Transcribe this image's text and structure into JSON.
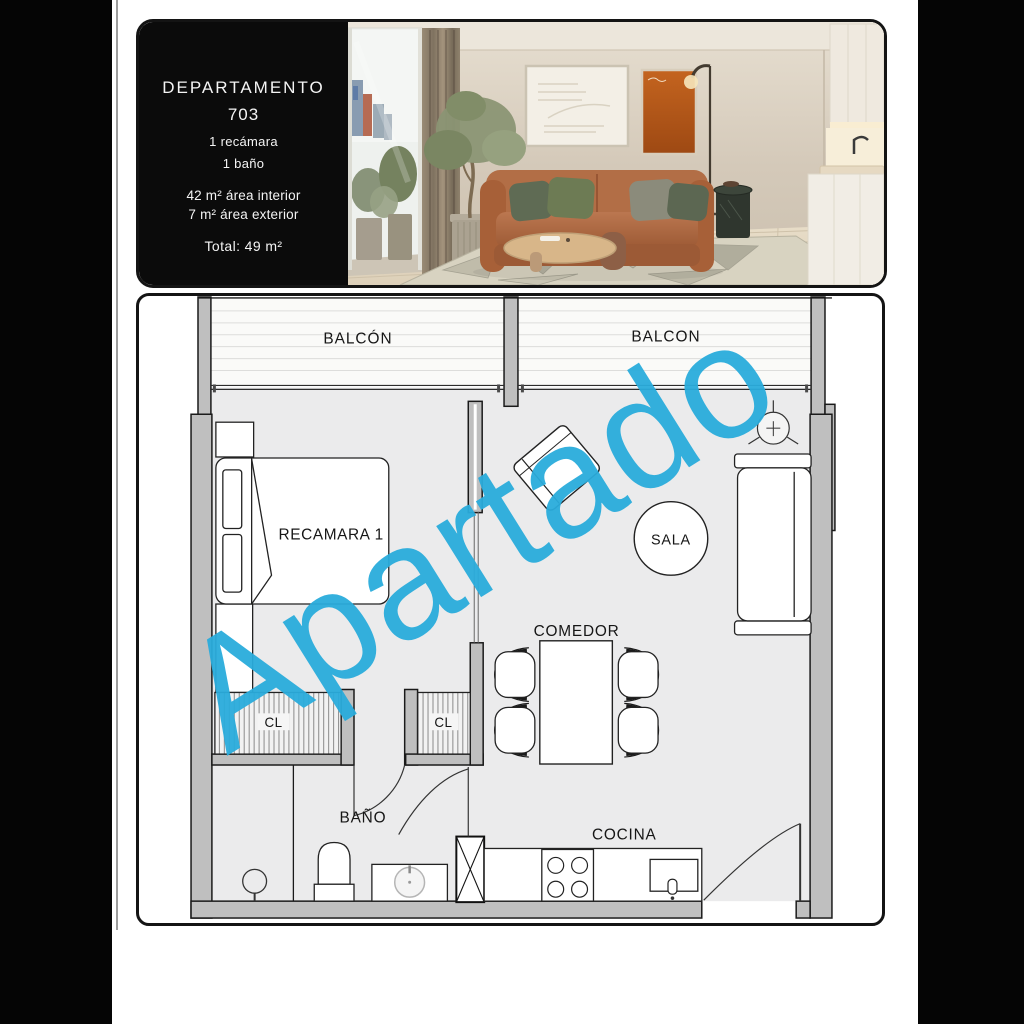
{
  "info_card": {
    "title": "DEPARTAMENTO",
    "unit_number": "703",
    "bedrooms": "1 recámara",
    "bathrooms": "1 baño",
    "area_interior": "42 m² área interior",
    "area_exterior": "7 m² área exterior",
    "area_total": "Total: 49 m²"
  },
  "floor_plan": {
    "labels": {
      "balcony_left": "BALCÓN",
      "balcony_right": "BALCON",
      "bedroom": "RECAMARA 1",
      "living_room": "SALA",
      "dining_room": "COMEDOR",
      "closet_1": "CL",
      "closet_2": "CL",
      "bathroom": "BAÑO",
      "kitchen": "COCINA"
    },
    "watermark": "Apartado"
  },
  "colors": {
    "watermark": "#2aacdc",
    "wall_fill": "#bfbfbf",
    "floor_fill": "#ebebec"
  }
}
